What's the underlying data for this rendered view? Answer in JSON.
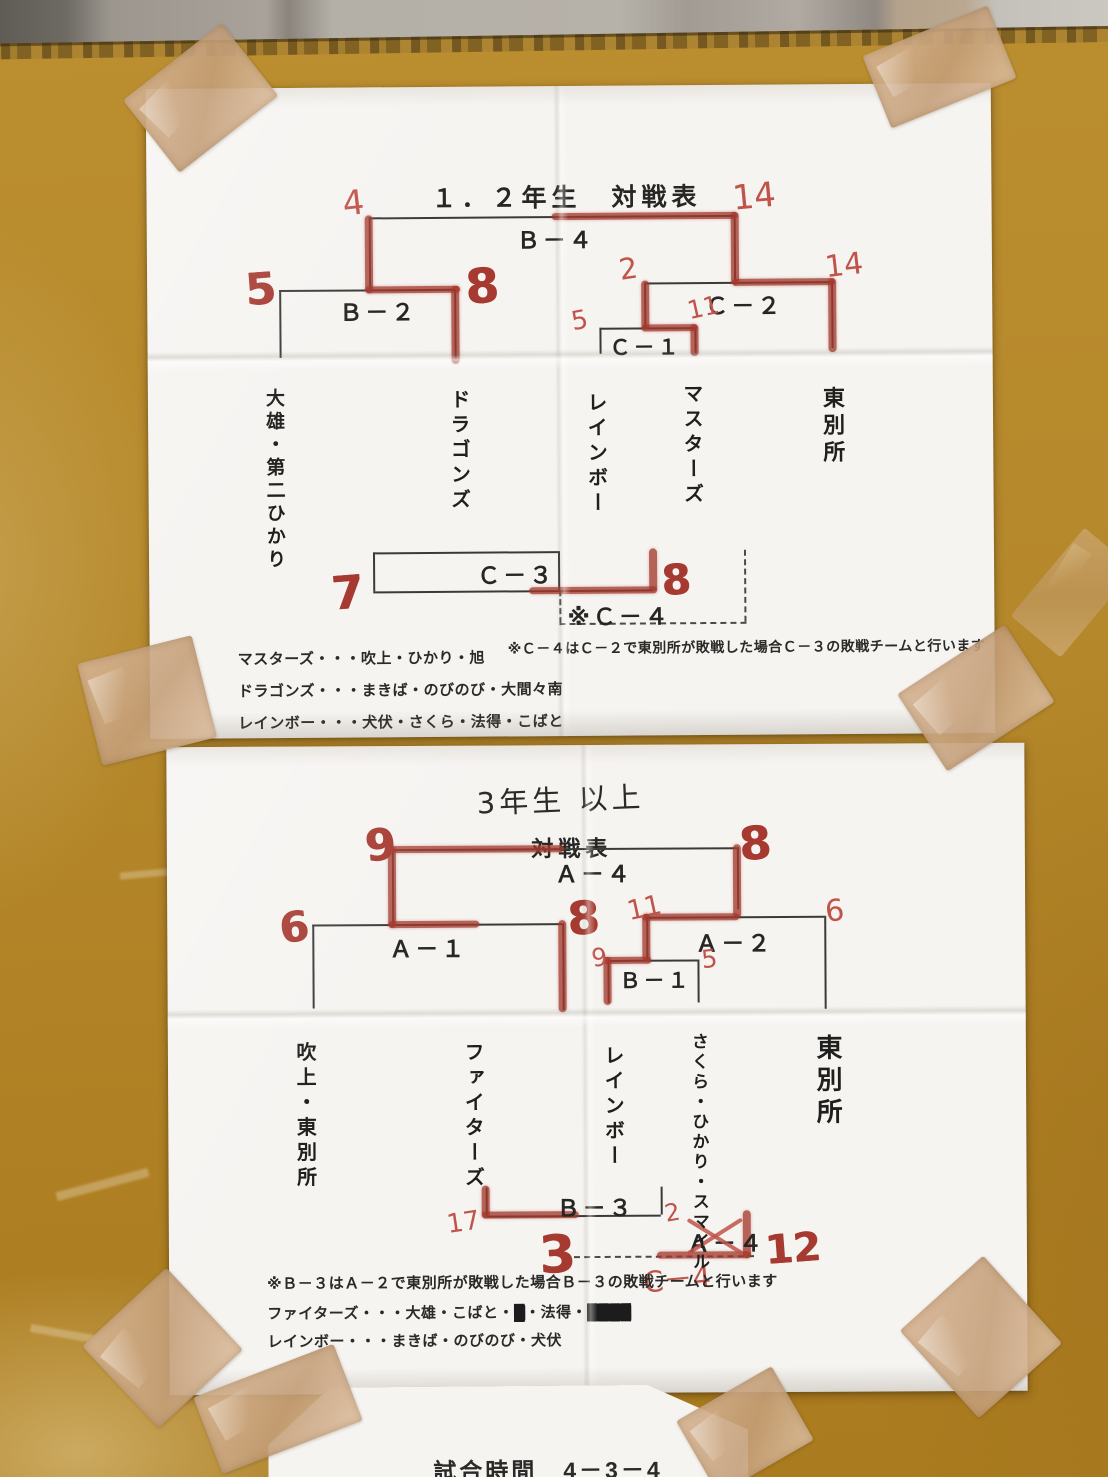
{
  "scene": {
    "board_color": "#b5882b",
    "paper_color": "#f6f4f1",
    "tape_color": "#c8a078",
    "marker_color": "#a63a30",
    "pen_color": "#c0544a"
  },
  "sheet1": {
    "title": "１．２年生　対戦表",
    "bracket": {
      "b4": {
        "label": "Ｂ－４",
        "left_score": "4",
        "right_score": "14"
      },
      "b2": {
        "label": "Ｂ－２",
        "left_score": "5",
        "right_score": "8"
      },
      "c2": {
        "label": "Ｃ－２",
        "left_score": "2",
        "right_score": "14"
      },
      "c1": {
        "label": "Ｃ－１",
        "left_score": "5",
        "right_score": "11"
      },
      "c3": {
        "label": "Ｃ－３",
        "left_score": "7",
        "right_score": "8"
      },
      "c4": {
        "label": "※Ｃ－４"
      }
    },
    "teams": [
      "大雄・第二ひかり",
      "ドラゴンズ",
      "レインボー",
      "マスターズ",
      "東別所"
    ],
    "note": "※Ｃ－４はＣ－２で東別所が敗戦した場合Ｃ－３の敗戦チームと行います",
    "legend": [
      "マスターズ・・・吹上・ひかり・旭",
      "ドラゴンズ・・・まきば・のびのび・大間々南",
      "レインボー・・・犬伏・さくら・法得・こばと"
    ]
  },
  "sheet2": {
    "title_handwritten": "3年生 以上",
    "title": "対戦表",
    "bracket": {
      "a4": {
        "label": "Ａ－４",
        "left_score": "9",
        "right_score": "8"
      },
      "a1": {
        "label": "Ａ－１",
        "left_score": "6",
        "right_score": "8"
      },
      "a2": {
        "label": "Ａ－２",
        "left_score": "11",
        "right_score": "6"
      },
      "b1": {
        "label": "Ｂ－１",
        "left_score": "9",
        "right_score": "5"
      },
      "b3": {
        "label": "Ｂ－３",
        "left_score": "17",
        "bottom_score": "3"
      },
      "c4": {
        "printed_label": "Ａ－４",
        "handwritten_label": "C－4",
        "left_score": "2",
        "right_score": "12"
      }
    },
    "teams": [
      "吹上・東別所",
      "ファイターズ",
      "レインボー",
      "さくら・ひかり・スマイル",
      "東別所"
    ],
    "note": "※Ｂ－３はＡ－２で東別所が敗戦した場合Ｂ－３の敗戦チームと行います",
    "legend": [
      {
        "segments": [
          {
            "t": "ファイターズ・・・大雄・こばと・"
          },
          {
            "t": "█",
            "struck": true
          },
          {
            "t": "・法得・"
          },
          {
            "t": "████",
            "struck": true
          }
        ]
      },
      {
        "segments": [
          {
            "t": "レインボー・・・まきば・のびのび・犬伏"
          }
        ]
      }
    ]
  },
  "sheet3": {
    "text": "試合時間　4－3－4"
  }
}
